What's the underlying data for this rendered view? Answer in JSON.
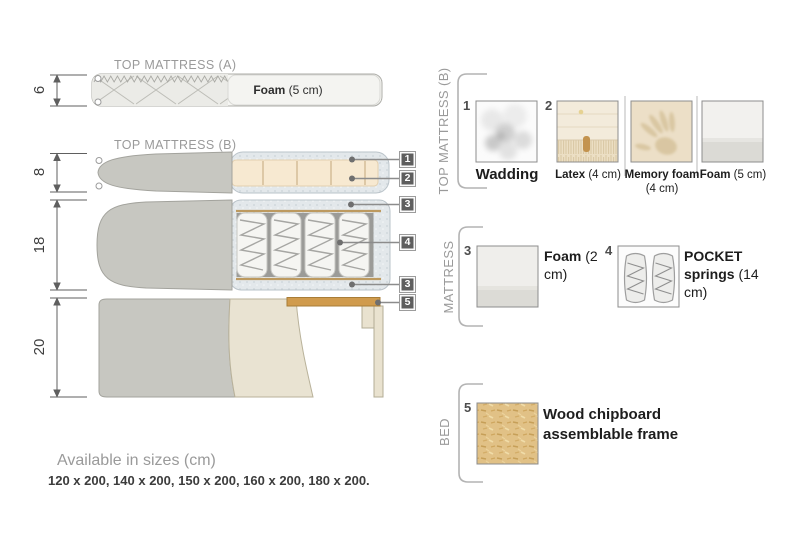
{
  "diagram": {
    "title_a": "TOP MATTRESS (A)",
    "title_b": "TOP MATTRESS (B)",
    "dim_a": "6",
    "dim_b": "8",
    "dim_mattress": "18",
    "dim_bed": "20",
    "foam_a": {
      "name": "Foam",
      "size": "(5 cm)"
    },
    "callouts": [
      "1",
      "2",
      "3",
      "4",
      "3",
      "5"
    ]
  },
  "legend": {
    "section_top_b": "TOP MATTRESS (B)",
    "section_mattress": "MATTRESS",
    "section_bed": "BED",
    "wadding": {
      "num": "1",
      "name": "Wadding"
    },
    "latex": {
      "num": "2",
      "name": "Latex",
      "size": "(4 cm)"
    },
    "memory": {
      "name": "Memory foam",
      "size": "(4 cm)"
    },
    "foam5": {
      "name": "Foam",
      "size": "(5 cm)"
    },
    "foam2": {
      "num": "3",
      "name": "Foam",
      "size": "(2 cm)"
    },
    "pocket": {
      "num": "4",
      "name": "POCKET springs",
      "size": "(14 cm)"
    },
    "wood": {
      "num": "5",
      "name": "Wood chipboard assemblable frame"
    }
  },
  "footer": {
    "title": "Available in sizes (cm)",
    "sizes": "120 x 200, 140 x 200, 150 x 200, 160 x 200, 180 x 200."
  },
  "colors": {
    "fabric_gray": "#c7c7c1",
    "fabric_beige": "#e9e3d2",
    "latex_peach": "#f7e9d1",
    "wadding_blue_gray": "#e3e8eb",
    "wood_slat": "#d09b4d",
    "callout_tag": "#5e5e5e"
  }
}
